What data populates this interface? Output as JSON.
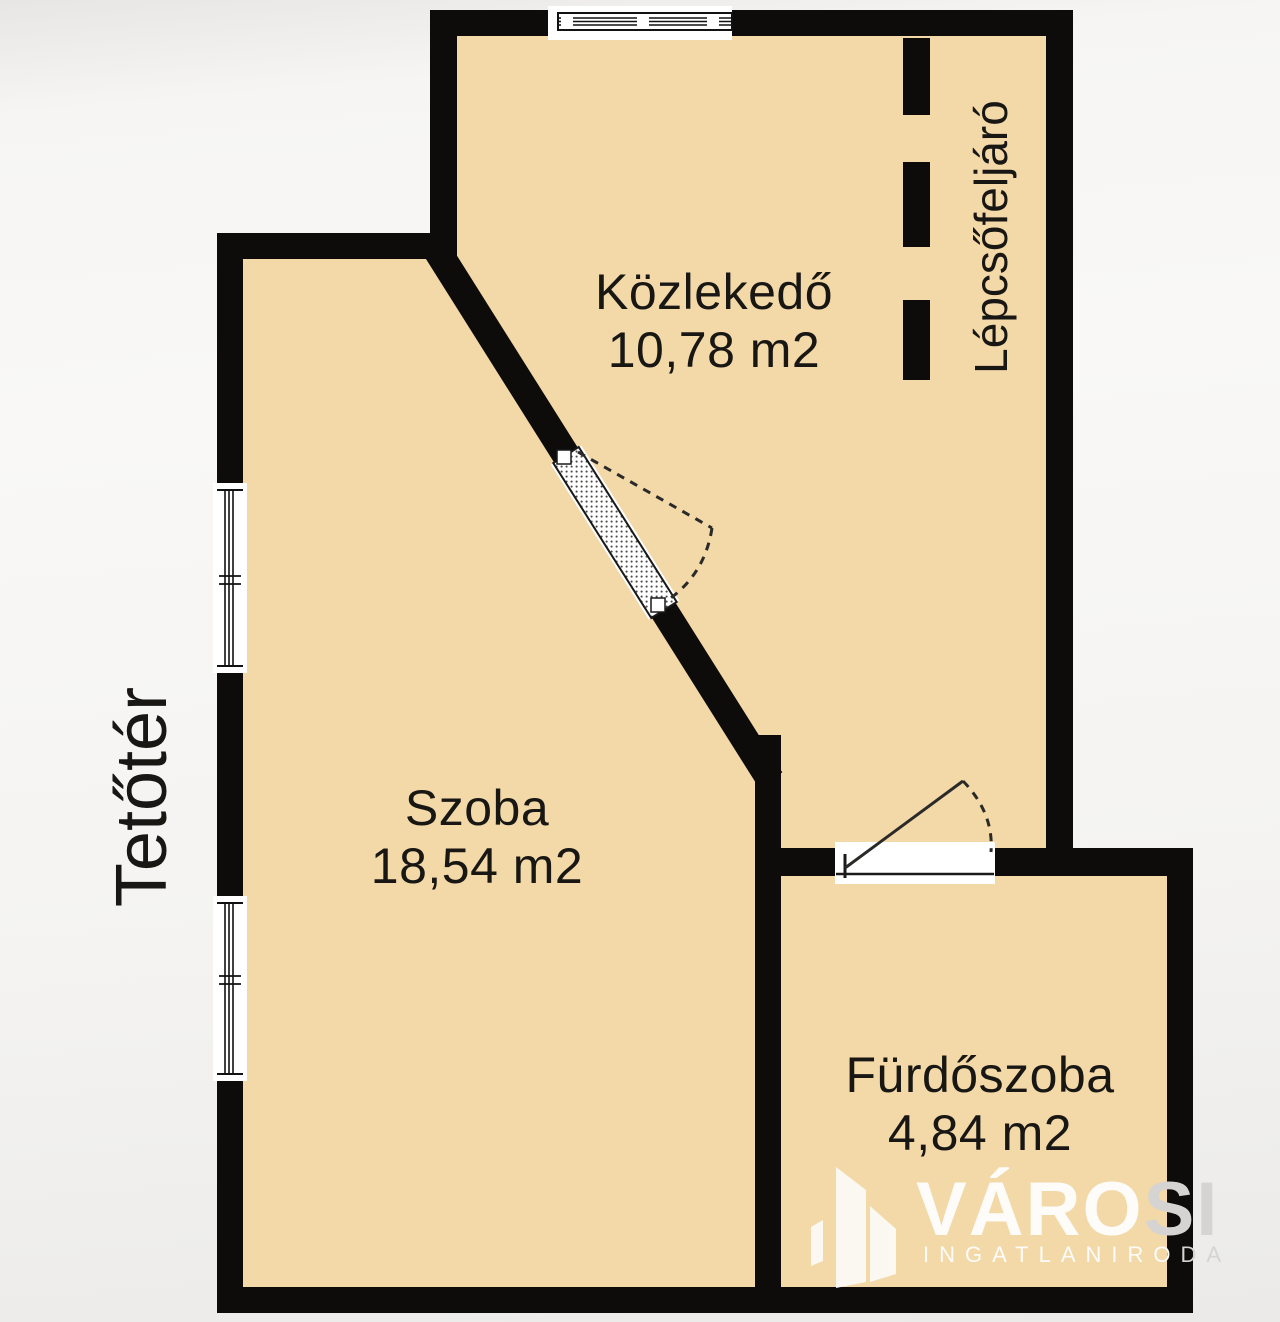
{
  "plan": {
    "rooms": [
      {
        "id": "kozlekedo",
        "name": "Közlekedő",
        "area": "10,78 m2"
      },
      {
        "id": "szoba",
        "name": "Szoba",
        "area": "18,54 m2"
      },
      {
        "id": "furdoszoba",
        "name": "Fürdőszoba",
        "area": "4,84 m2"
      }
    ],
    "annotations": {
      "attic_label": "Tetőtér",
      "staircase_label": "Lépcsőfeljáró"
    },
    "colors": {
      "room_fill": "#f3d8a8",
      "wall": "#0d0c0a",
      "opening_white": "#ffffff",
      "label_text": "#181714",
      "background": "#f6f5f3"
    }
  },
  "watermark": {
    "brand_main": "VÁRO",
    "brand_tail": "SI",
    "subtitle_main": "INGATLANIRO",
    "subtitle_tail": "DA",
    "icon": "buildings-icon",
    "color": "#fdfcf9",
    "tail_color": "#d5d4d2"
  }
}
